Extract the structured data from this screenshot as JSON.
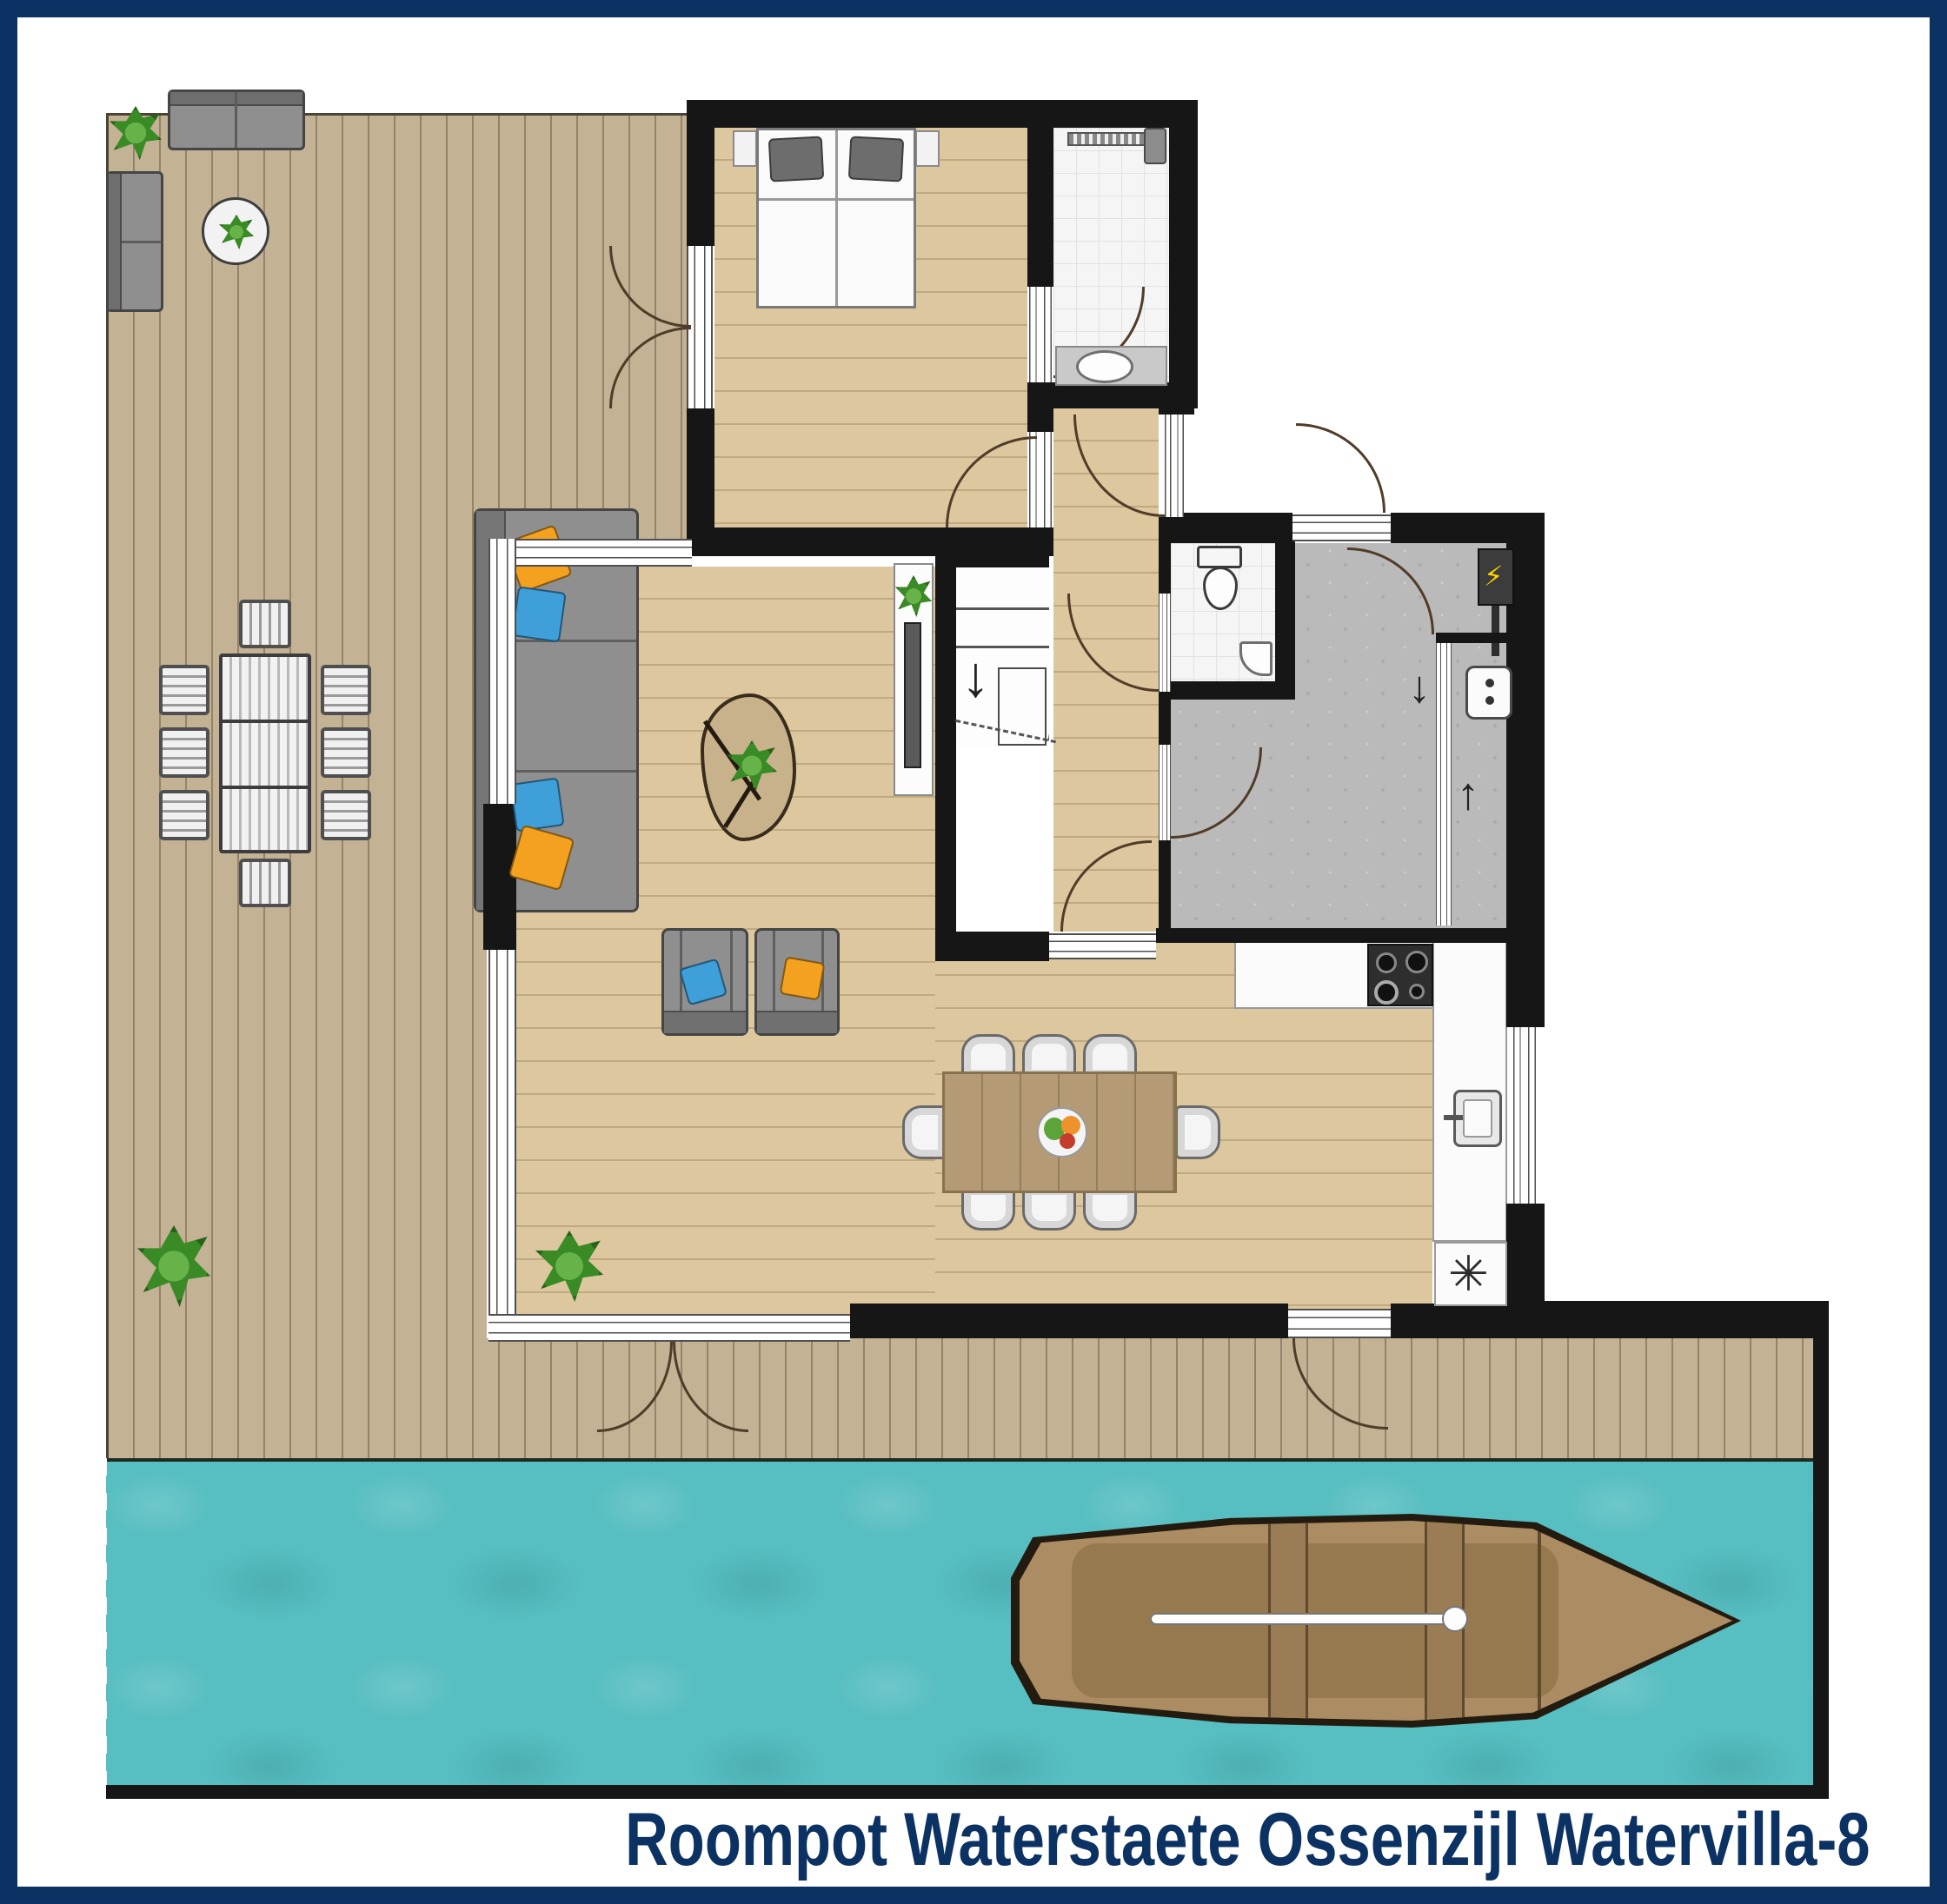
{
  "caption": {
    "text": "Roompot Waterstaete Ossenzijl Watervilla-8"
  },
  "symbols": {
    "washing_machine": "✳",
    "arrow_down": "↓",
    "arrow_up": "↑",
    "stairs_arrow": "↓",
    "electric": "⚡"
  },
  "colors": {
    "navy": "#0b3262",
    "deck": "#c3b294",
    "deckedge": "#4a4435",
    "water": "#57bec1",
    "wall": "#161616",
    "wood": "#dcc79f",
    "tile": "#f5f5f5",
    "tileline": "#e2e2e2",
    "gray": "#bababa",
    "glzline": "#4f4f4f",
    "arc": "#503c28",
    "orange": "#f3a11e",
    "blue": "#3f9fd9",
    "plant": "#3a8a26",
    "plantdark": "#27631a",
    "sofa": "#8f8f8f",
    "tablewood": "#b49b75",
    "boatdark": "#241b10",
    "boatdeck": "#ac8d63",
    "boatfloor": "#97794f"
  }
}
